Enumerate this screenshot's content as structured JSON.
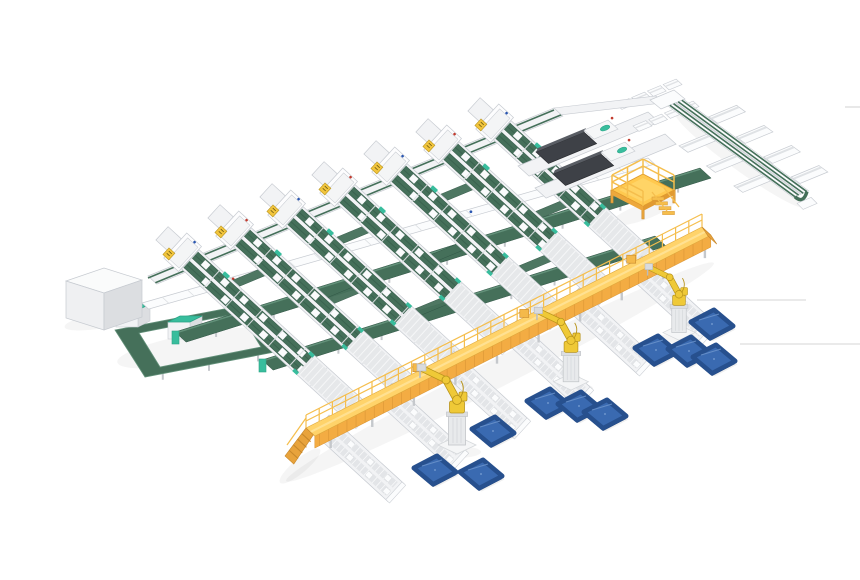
{
  "scene": {
    "name": "automated-sorting-line-3d-render",
    "width": 860,
    "height": 580,
    "background": "#ffffff"
  },
  "colors": {
    "belt": "#45705A",
    "beltDark": "#305545",
    "beltLight": "#63917A",
    "teal": "#38BD9D",
    "tealDark": "#2BA385",
    "frame": "#F2F3F5",
    "frameStroke": "#C7CBD1",
    "frameWhite": "#FBFCFD",
    "grayTrack": "#E6E8EA",
    "tie": "#DDE0E3",
    "leg": "#C5C8CC",
    "walkTop": "#FFD36A",
    "walkHi": "#FFE59C",
    "walkFront": "#F3AC43",
    "walkSeam": "#D89434",
    "rail": "#F5BE4D",
    "rampSide": "#E8A33C",
    "rampStep": "#C8882B",
    "robot": "#EFC937",
    "robotDark": "#B8941C",
    "robotGray": "#E8EAEC",
    "robotGrayStroke": "#C2C5C9",
    "panel": "#3A6AB1",
    "panelDark": "#27508E",
    "panelSide": "#1E3C6B",
    "panelHi": "#6C94CC",
    "machine": "#3E4147",
    "machineTop": "#595D64",
    "machineDark": "#2B2D31",
    "cabinetTop": "#FAFBFB",
    "cabinetLeft": "#EFF0F2",
    "cabinetRight": "#DCDEE1",
    "red": "#C23B2E",
    "blue": "#2A56B0",
    "artifact": "#DADADA",
    "shadow": "#333333"
  },
  "grid": {
    "laneAngle": 42.5,
    "spine": [
      148,
      276,
      554,
      108
    ],
    "lanes": [
      [
        190,
        259,
        236
      ],
      [
        242,
        237,
        232
      ],
      [
        294,
        216,
        227
      ],
      [
        346,
        194,
        223
      ],
      [
        398,
        173,
        217
      ],
      [
        450,
        151,
        213
      ],
      [
        502,
        130,
        208
      ]
    ],
    "grayLen": 80,
    "chutes": [
      [
        0,
        46
      ],
      [
        2,
        46
      ],
      [
        4,
        46
      ],
      [
        1,
        104
      ],
      [
        3,
        104
      ],
      [
        5,
        104
      ],
      [
        2,
        152
      ],
      [
        4,
        152
      ]
    ]
  },
  "crossers": {
    "w1": [
      142,
      303,
      648,
      158
    ],
    "c1": [
      175,
      332,
      700,
      168
    ],
    "c2": [
      262,
      360,
      655,
      236
    ]
  },
  "loop": {
    "outer": [
      [
        115,
        330
      ],
      [
        255,
        303
      ],
      [
        285,
        350
      ],
      [
        145,
        377
      ]
    ],
    "inner": [
      [
        139,
        333
      ],
      [
        240,
        313
      ],
      [
        261,
        347
      ],
      [
        160,
        367
      ]
    ],
    "machines": [
      [
        116,
        306
      ],
      [
        168,
        318
      ]
    ]
  },
  "cabinet": {
    "x": 104,
    "y": 281
  },
  "machines": {
    "lanes": [
      [
        518,
        166,
        648,
        112
      ],
      [
        535,
        188,
        665,
        134
      ]
    ],
    "bodies": [
      [
        536,
        152
      ],
      [
        553,
        174
      ]
    ],
    "trayRows": [
      [
        616,
        104
      ],
      [
        633,
        126
      ]
    ],
    "connector": [
      554,
      108,
      656,
      96
    ],
    "corner": [
      [
        650,
        100
      ],
      [
        674,
        90
      ],
      [
        685,
        99
      ],
      [
        661,
        109
      ]
    ]
  },
  "rightLine": {
    "start": [
      668,
      106
    ],
    "dir": [
      0.807,
      0.59
    ],
    "len": 155,
    "traysUp": [
      30,
      64,
      98,
      132
    ],
    "traysDown": [
      48,
      82,
      116
    ]
  },
  "platform": {
    "cx": 643,
    "cy": 190
  },
  "walkway": {
    "g1": [
      306,
      448
    ],
    "g2": [
      702,
      247
    ],
    "lift": 20,
    "width": 12
  },
  "stubs": [
    [
      332,
      434
    ],
    [
      395,
      402
    ],
    [
      457,
      370
    ],
    [
      520,
      339
    ],
    [
      582,
      307
    ],
    [
      645,
      275
    ]
  ],
  "robots": [
    {
      "x": 457,
      "y": 442,
      "s": 1.0
    },
    {
      "x": 571,
      "y": 379,
      "s": 0.92
    },
    {
      "x": 679,
      "y": 330,
      "s": 0.85
    }
  ],
  "panels": [
    [
      493,
      431
    ],
    [
      435,
      470
    ],
    [
      481,
      474
    ],
    [
      548,
      403
    ],
    [
      579,
      406
    ],
    [
      605,
      414
    ],
    [
      656,
      350
    ],
    [
      689,
      351
    ],
    [
      714,
      359
    ],
    [
      712,
      324
    ]
  ],
  "artifact_lines": [
    [
      740,
      344,
      860,
      344
    ],
    [
      697,
      300,
      806,
      300
    ],
    [
      845,
      107,
      860,
      107
    ]
  ],
  "shadows": [
    [
      500,
      372,
      240,
      14,
      -27
    ],
    [
      198,
      348,
      82,
      15,
      -10
    ],
    [
      104,
      320,
      40,
      8,
      -10
    ],
    [
      457,
      452,
      24,
      6,
      0
    ],
    [
      571,
      388,
      22,
      5,
      0
    ],
    [
      679,
      338,
      20,
      5,
      0
    ],
    [
      643,
      212,
      34,
      8,
      -20
    ],
    [
      740,
      160,
      80,
      10,
      36
    ],
    [
      300,
      466,
      26,
      7,
      -40
    ]
  ]
}
